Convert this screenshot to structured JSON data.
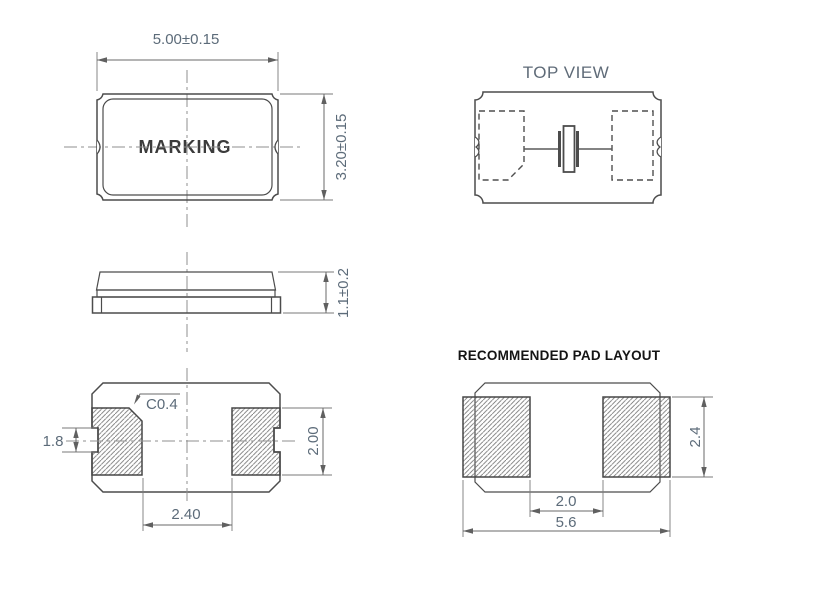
{
  "colors": {
    "background": "#ffffff",
    "outline": "#4c4c4c",
    "dimension_line": "#6a6a6a",
    "centerline": "#8f8f8f",
    "dim_text": "#5c6b79",
    "marking_text": "#3b3b3b",
    "top_view_text": "#5f6b78",
    "title_text": "#141414",
    "hatch": "#747474"
  },
  "front_view": {
    "dim_width": "5.00±0.15",
    "dim_height": "3.20±0.15",
    "marking": "MARKING"
  },
  "top_view": {
    "title": "TOP VIEW"
  },
  "side_view": {
    "dim_thickness": "1.1±0.2"
  },
  "bottom_view": {
    "chamfer": "C0.4",
    "dim_castellation": "1.8",
    "dim_pad_height": "2.00",
    "dim_pad_gap": "2.40"
  },
  "pad_layout": {
    "title": "RECOMMENDED PAD LAYOUT",
    "dim_gap": "2.0",
    "dim_overall_width": "5.6",
    "dim_pad_height": "2.4"
  }
}
